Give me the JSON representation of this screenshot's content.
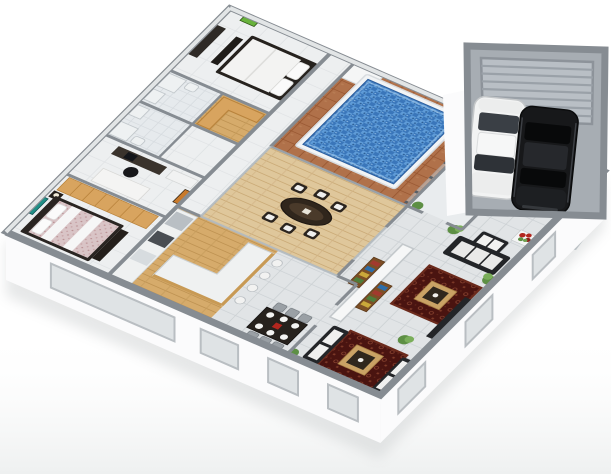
{
  "scene": {
    "type": "3d-floor-plan-render",
    "description": "Isometric 3D rendered floor plan of a single-storey house with a central wooden courtyard, rectangular swimming pool with glass fence, and a detached double garage with a white and a black car",
    "background": "#ffffff"
  },
  "palette": {
    "wall_cap": "#868c92",
    "wall_face": "#fbfbfc",
    "window_glass": "#dfe3e5",
    "window_frame": "#b9bec2",
    "tile_light": "#edeff0",
    "tile_gray": "#e1e4e6",
    "bath_tile": "#e6eaed",
    "corridor_tile": "#e4e7e9",
    "deck_wood": "#dfc79b",
    "kitchen_wood": "#d6ab6b",
    "pool_deck": "#b0714a",
    "pool_water": "#3a76ba",
    "pool_coping": "#f2f4f5",
    "glass_fence": "#c3cbd1",
    "fence_post": "#585f66",
    "rug": "#4a1410",
    "rug_table_wood": "#c9a265",
    "wardrobe_wood": "#d8a45f",
    "sofa_dark": "#232528",
    "cushion_white": "#efefee",
    "plant_green": "#5d8f44",
    "flower_red": "#b3261e",
    "garage_floor": "#a7adb3",
    "garage_door": "#b9bfc5",
    "driveway": "#bcc2c7",
    "car_white": "#f2f3f3",
    "car_black": "#17181a",
    "counter_top": "#eff1f1",
    "art_green": "#68b23c",
    "art_teal": "#1f8f86",
    "art_orange": "#c97a2b"
  },
  "rooms": [
    {
      "name": "master-bedroom",
      "floor": "light tile",
      "furniture": [
        "double bed",
        "foot bench",
        "dresser",
        "green wall art"
      ]
    },
    {
      "name": "bathroom-1",
      "floor": "bath tile",
      "furniture": [
        "shower",
        "sink",
        "toilet"
      ]
    },
    {
      "name": "walk-in-wardrobe",
      "floor": "wood",
      "furniture": [
        "L-shaped timber wardrobe"
      ]
    },
    {
      "name": "bathroom-2",
      "floor": "bath tile",
      "furniture": [
        "shower",
        "sink",
        "toilet"
      ]
    },
    {
      "name": "home-office",
      "floor": "light tile",
      "furniture": [
        "desk",
        "office chair",
        "cabinet",
        "daybed",
        "orange wall art"
      ]
    },
    {
      "name": "bedroom-2",
      "floor": "light tile",
      "furniture": [
        "double bed with floral duvet",
        "timber wardrobe",
        "nightstand with lamp",
        "teal wall art"
      ]
    },
    {
      "name": "corridor",
      "floor": "light tile",
      "furniture": []
    },
    {
      "name": "pool-terrace",
      "floor": "terracotta tile",
      "furniture": [
        "rectangular pool",
        "glass fence",
        "white equipment box"
      ]
    },
    {
      "name": "courtyard-deck",
      "floor": "timber deck",
      "furniture": [
        "oval outdoor table",
        "6 outdoor chairs"
      ]
    },
    {
      "name": "kitchen",
      "floor": "timber",
      "furniture": [
        "appliance run",
        "L-shaped island bench",
        "4 bar stools"
      ]
    },
    {
      "name": "dining-area",
      "floor": "gray tile",
      "furniture": [
        "dark dining table",
        "6 place settings",
        "6 gray chairs",
        "potted plant"
      ]
    },
    {
      "name": "living-area",
      "floor": "gray tile",
      "furniture": [
        "dark sofa",
        "two red patterned rugs",
        "two square coffee tables",
        "white partition with shelf units",
        "media bench",
        "white sofas",
        "potted plants"
      ]
    },
    {
      "name": "entry-hall",
      "floor": "gray tile",
      "furniture": [
        "white loveseat",
        "console with red flowers",
        "potted plant"
      ]
    },
    {
      "name": "garage",
      "floor": "concrete gray",
      "furniture": [
        "roller door",
        "white car",
        "black car"
      ]
    }
  ],
  "pool": {
    "shape": "rectangular",
    "water_color": "#3a76ba",
    "coping": "white",
    "fence": "glass with metal posts",
    "post_count": 15
  },
  "garage": {
    "door": "gray roller door",
    "cars": [
      {
        "color": "white"
      },
      {
        "color": "black"
      }
    ],
    "driveway": "gray path"
  }
}
